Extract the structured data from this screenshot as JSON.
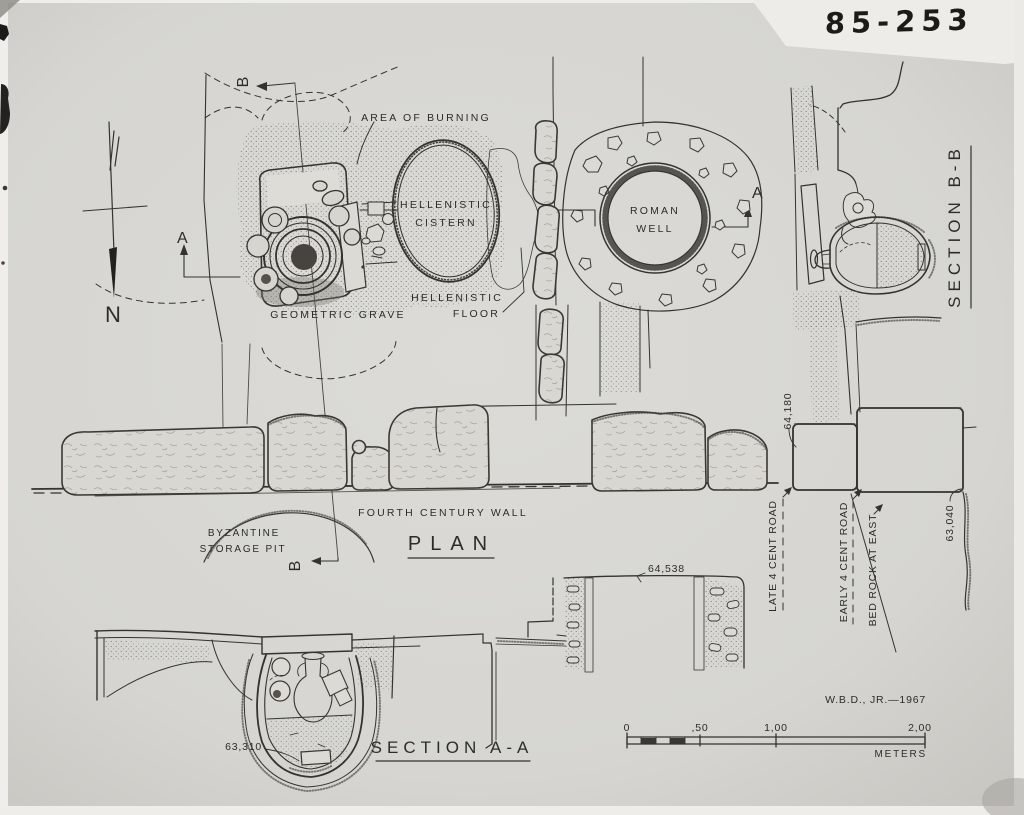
{
  "drawing_number": "85-253",
  "credit": "W.B.D., JR.—1967",
  "compass": {
    "north": "N"
  },
  "plan": {
    "title": "PLAN",
    "labels": {
      "area_of_burning": "AREA OF BURNING",
      "cistern_1": "HELLENISTIC",
      "cistern_2": "CISTERN",
      "well_1": "ROMAN",
      "well_2": "WELL",
      "grave": "GEOMETRIC GRAVE",
      "floor_1": "HELLENISTIC",
      "floor_2": "FLOOR",
      "wall": "FOURTH CENTURY WALL",
      "pit_1": "BYZANTINE",
      "pit_2": "STORAGE PIT"
    },
    "markers": {
      "a": "A",
      "b": "B"
    }
  },
  "section_aa": {
    "title": "SECTION A-A",
    "elevations": {
      "amphora_base": "63,310",
      "well_top": "64,538"
    }
  },
  "section_bb": {
    "title": "SECTION B-B",
    "elevations": {
      "road": "64,180",
      "bedrock": "63,040"
    },
    "annotations": {
      "late_road": "LATE 4  CENT ROAD",
      "early_road": "EARLY 4  CENT ROAD",
      "bedrock_east": "BED ROCK AT EAST"
    }
  },
  "scale_bar": {
    "ticks": [
      "0",
      ",50",
      "1,00",
      "2,00"
    ],
    "unit": "METERS"
  }
}
